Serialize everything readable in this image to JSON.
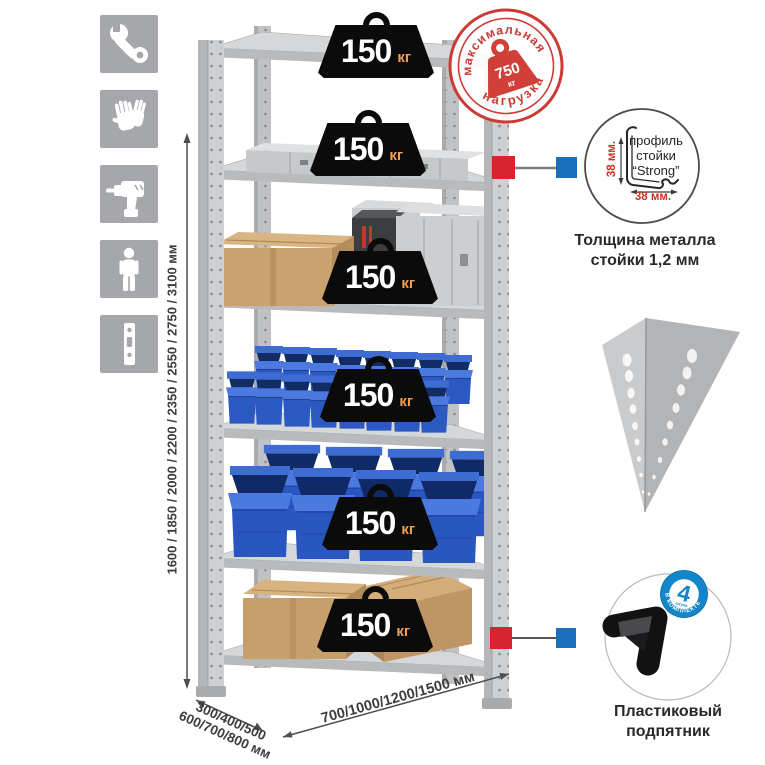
{
  "left_icon_panel": {
    "tile_color": "#a5a7aa",
    "items": [
      {
        "name": "wrench"
      },
      {
        "name": "gloves"
      },
      {
        "name": "drill"
      },
      {
        "name": "person"
      },
      {
        "name": "post-profile"
      }
    ]
  },
  "dimension_labels": {
    "height": "1600 / 1850 / 2000 / 2200 / 2350 / 2550 / 2750 / 3100 мм",
    "depth_line1": "300/400/500",
    "depth_line2": "600/700/800 мм",
    "width": "700/1000/1200/1500 мм"
  },
  "shelf_load_badge": {
    "value": "150",
    "unit": "кг",
    "count": 6
  },
  "max_load_stamp": {
    "arc_top": "максимальная",
    "arc_bottom": "нагрузка",
    "value": "750",
    "unit": "кг",
    "color": "#cb3b34"
  },
  "profile_detail": {
    "label_line1": "профиль",
    "label_line2": "стойки",
    "label_line3": "“Strong”",
    "dim_side": "38 мм.",
    "dim_bottom": "38 мм.",
    "caption_line1": "Толщина металла",
    "caption_line2": "стойки 1,2 мм"
  },
  "foot_detail": {
    "badge_number": "4",
    "badge_small": "штуки",
    "badge_arc": "в комплекте",
    "badge_color": "#1286c8",
    "caption_line1": "Пластиковый",
    "caption_line2": "подпятник"
  },
  "colors": {
    "marker_red": "#d6252e",
    "marker_blue": "#1c6fbc",
    "bin_blue": "#2c58c2",
    "cardboard": "#c9a26f",
    "metal_light": "#d5d7d9",
    "badge_black": "#0b0b0b",
    "badge_unit_orange": "#f0a050"
  }
}
